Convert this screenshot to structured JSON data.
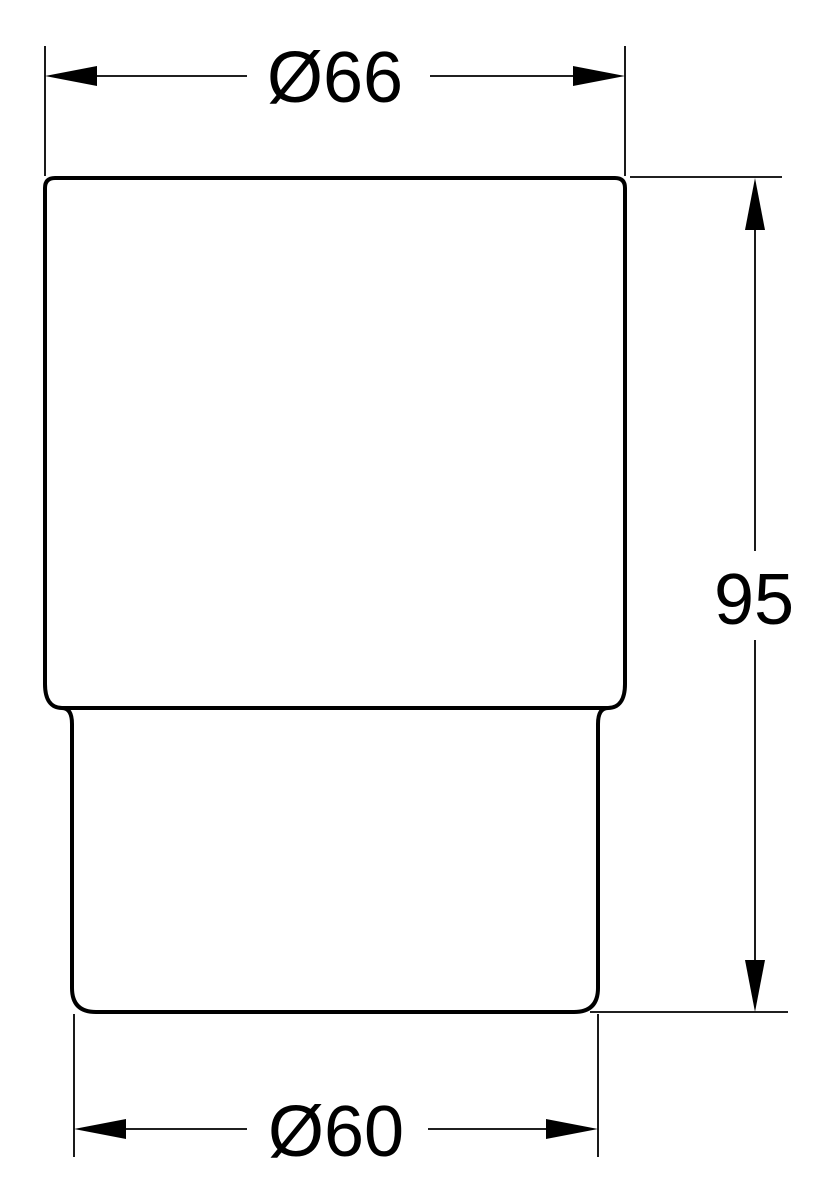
{
  "drawing": {
    "background_color": "#ffffff",
    "line_color": "#000000",
    "object": "tumbler-elevation-outline",
    "dimensions": {
      "top_diameter": {
        "label": "Ø66",
        "value": 66
      },
      "height": {
        "label": "95",
        "value": 95
      },
      "bottom_diameter": {
        "label": "Ø60",
        "value": 60
      }
    }
  }
}
